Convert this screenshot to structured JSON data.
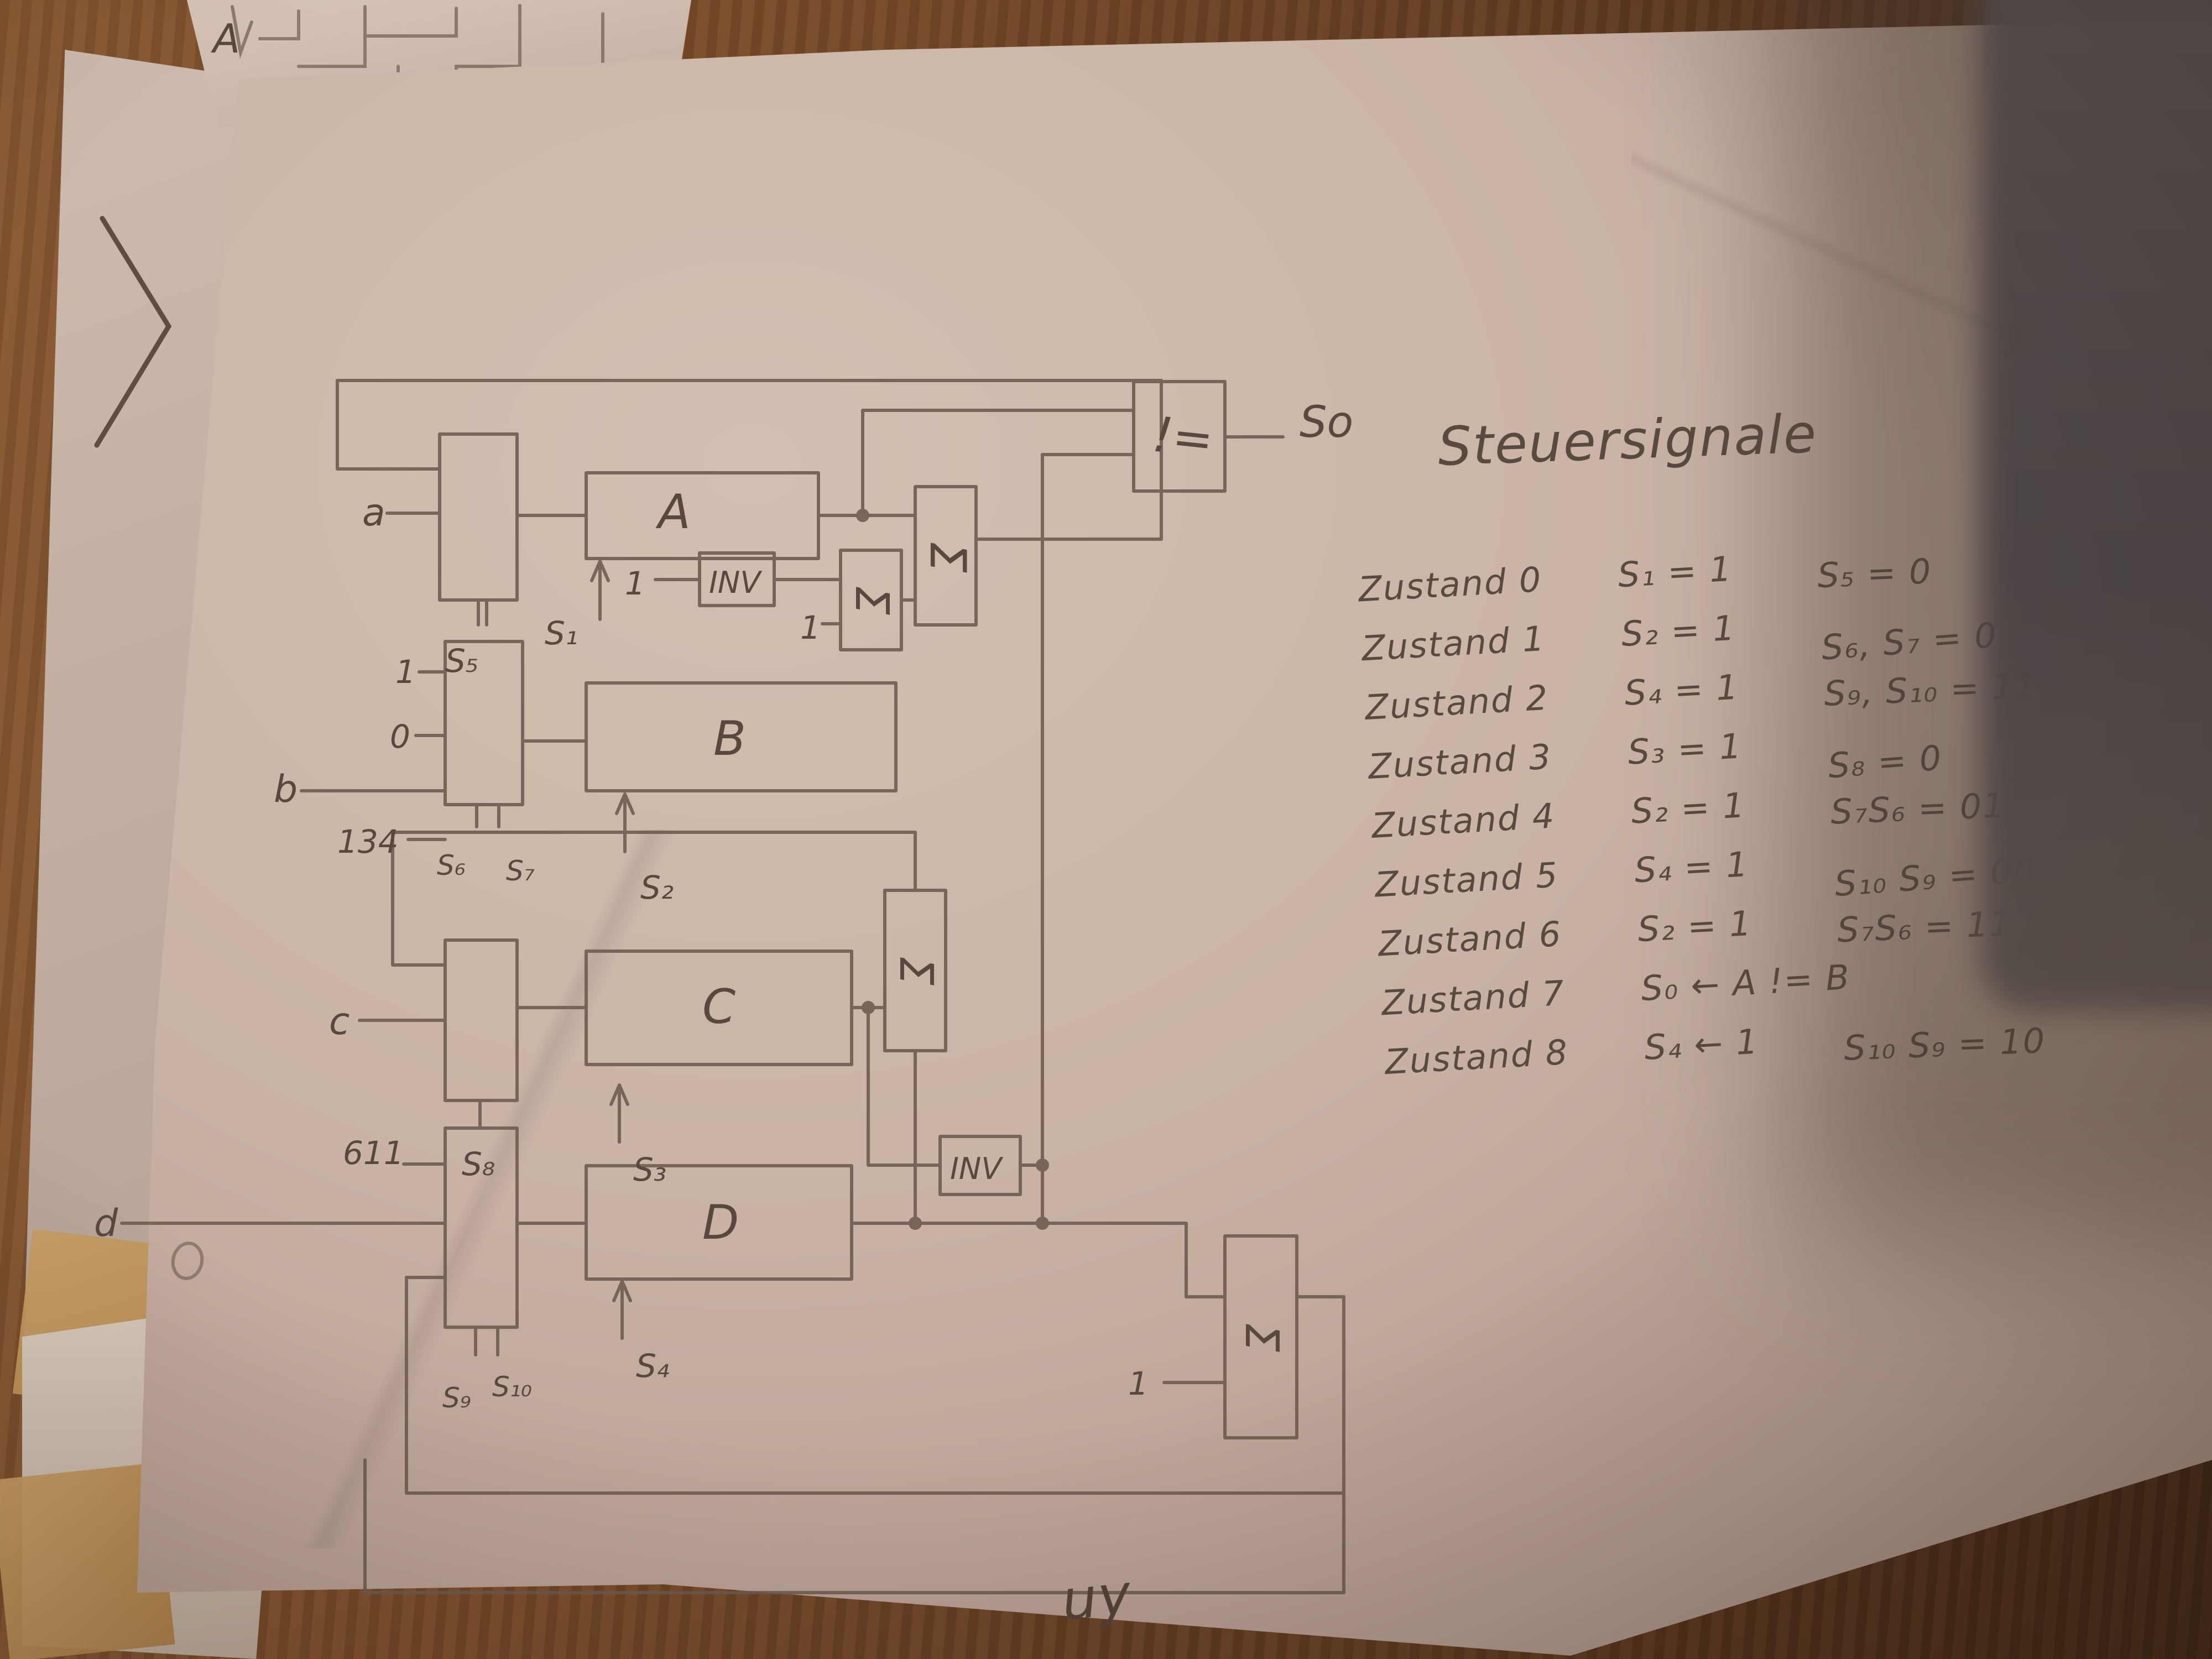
{
  "title": "Steuersignale",
  "states": [
    {
      "name": "Zustand 0",
      "a": "S₁ = 1",
      "b": "S₅ = 0"
    },
    {
      "name": "Zustand 1",
      "a": "S₂ = 1",
      "b": "S₆, S₇ = 0"
    },
    {
      "name": "Zustand 2",
      "a": "S₄ = 1",
      "b": "S₉, S₁₀ = 11"
    },
    {
      "name": "Zustand 3",
      "a": "S₃ = 1",
      "b": "S₈ = 0"
    },
    {
      "name": "Zustand 4",
      "a": "S₂ = 1",
      "b": "S₇S₆ = 01"
    },
    {
      "name": "Zustand 5",
      "a": "S₄ = 1",
      "b": "S₁₀ S₉ = 00"
    },
    {
      "name": "Zustand 6",
      "a": "S₂ = 1",
      "b": "S₇S₆ = 11"
    },
    {
      "name": "Zustand 7",
      "a": "S₀ ← A != B",
      "b": ""
    },
    {
      "name": "Zustand 8",
      "a": "S₄ ← 1",
      "b": "S₁₀ S₉ = 10"
    }
  ],
  "diagram": {
    "registers": {
      "a": "A",
      "b": "B",
      "c": "C",
      "d": "D"
    },
    "loads": {
      "s1": "S₁",
      "s2": "S₂",
      "s3": "S₃",
      "s4": "S₄"
    },
    "selects": {
      "s5": "S₅",
      "s6": "S₆",
      "s7": "S₇",
      "s8": "S₈",
      "s9": "S₉",
      "s10": "S₁₀"
    },
    "inputs": {
      "a": "a",
      "b": "b",
      "c": "c",
      "d": "d"
    },
    "constants": {
      "one": "1",
      "zero": "0",
      "c134": "134",
      "c611": "611"
    },
    "inv": "INV",
    "sigma": "Σ",
    "neq": "!=",
    "out": "So"
  },
  "background": {
    "sheet_label": "A"
  },
  "stray": {
    "bottom": "uy"
  },
  "colors": {
    "paper": "#cab3a5",
    "pencil": "#6d5a50",
    "wood": "#7a4c2a",
    "shadow": "#4c4546"
  }
}
